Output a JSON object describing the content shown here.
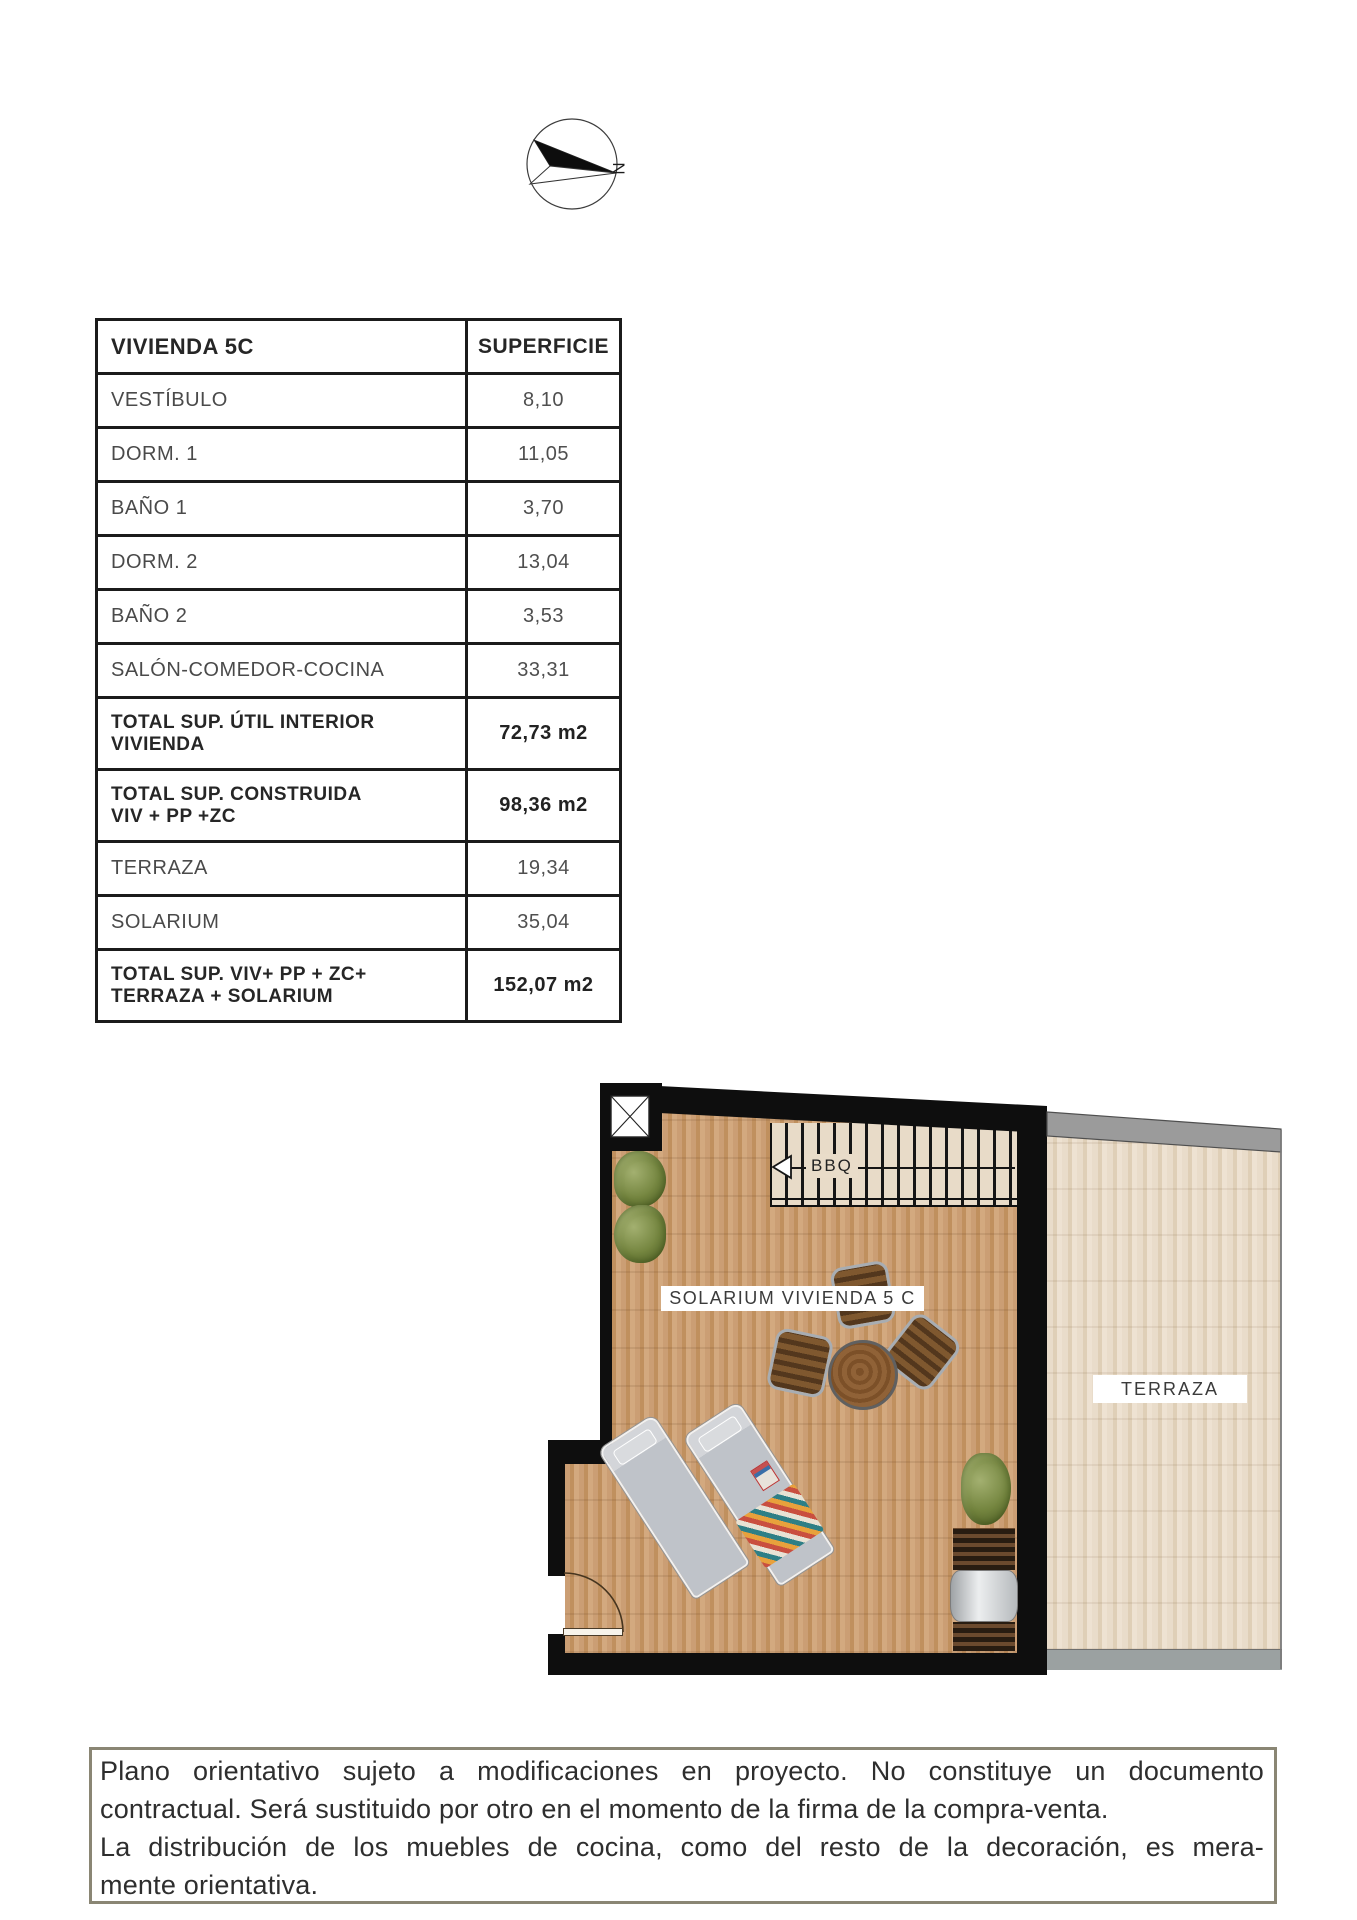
{
  "compass": {
    "north_label": "N"
  },
  "table": {
    "header": {
      "name": "VIVIENDA 5C",
      "area": "SUPERFICIE"
    },
    "rows": [
      {
        "label": "VESTÍBULO",
        "value": "8,10"
      },
      {
        "label": "DORM. 1",
        "value": "11,05"
      },
      {
        "label": "BAÑO 1",
        "value": "3,70"
      },
      {
        "label": "DORM. 2",
        "value": "13,04"
      },
      {
        "label": "BAÑO 2",
        "value": "3,53"
      },
      {
        "label": "SALÓN-COMEDOR-COCINA",
        "value": "33,31"
      },
      {
        "label": "TOTAL SUP. ÚTIL INTERIOR\nVIVIENDA",
        "value": "72,73 m2"
      },
      {
        "label": "TOTAL SUP. CONSTRUIDA\nVIV + PP +ZC",
        "value": "98,36 m2"
      },
      {
        "label": "TERRAZA",
        "value": "19,34"
      },
      {
        "label": "SOLARIUM",
        "value": "35,04"
      },
      {
        "label": "TOTAL SUP. VIV+ PP + ZC+\nTERRAZA + SOLARIUM",
        "value": "152,07 m2"
      }
    ]
  },
  "floorplan": {
    "solarium_label": "SOLARIUM VIVIENDA 5 C",
    "terraza_label": "TERRAZA",
    "bbq_label": "BBQ"
  },
  "disclaimer": {
    "line1": "Plano orientativo sujeto a modificaciones en proyecto. No constituye un documento",
    "line2": "contractual. Será sustituido por otro en el momento de la firma de la compra-venta.",
    "line3": "La distribución de los muebles de cocina, como del resto de la decoración, es mera-",
    "line4": "mente orientativa."
  },
  "palette": {
    "wall": "#0e0e0e",
    "solarium_wood": "#c89b72",
    "terraza_wood": "#e7dac8",
    "gray_band": "#9b9b9b",
    "disclaimer_border": "#8a8674"
  }
}
